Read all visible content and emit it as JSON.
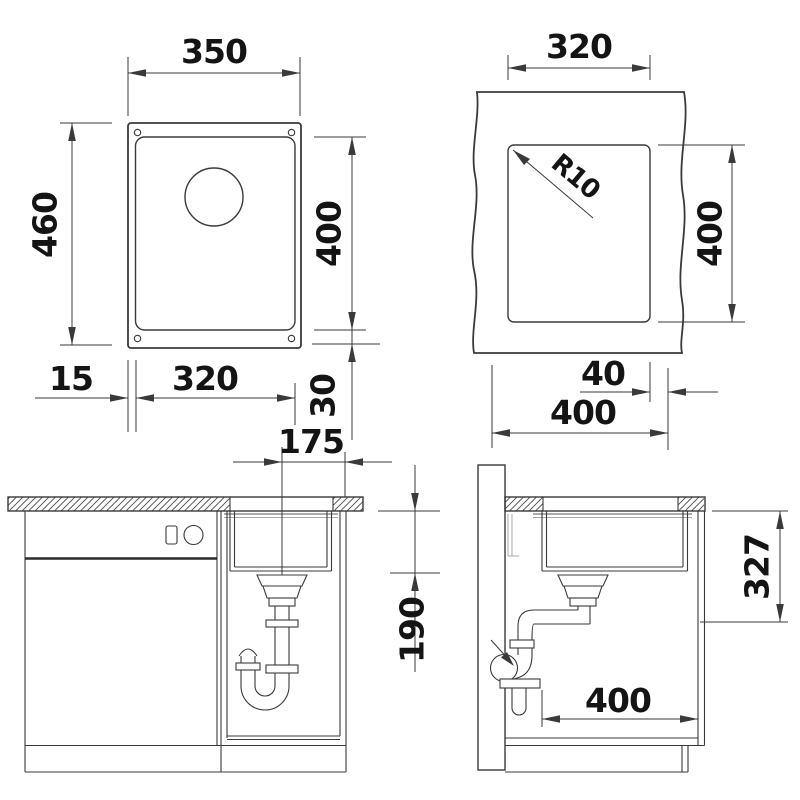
{
  "drawing": {
    "line_color": "#3a3a3a",
    "text_color": "#141414",
    "views": {
      "top_view": {
        "name": "Sink top view",
        "dim_overall_width": "350",
        "dim_overall_depth": "460",
        "dim_bowl_depth": "400",
        "dim_bowl_width": "320",
        "dim_side_offset": "15",
        "dim_bottom_offset": "30"
      },
      "cutout_view": {
        "name": "Worktop cutout view",
        "dim_cutout_width": "320",
        "dim_cutout_depth": "400",
        "corner_radius": "R10",
        "dim_edge_distance": "40",
        "dim_cabinet_width": "400"
      },
      "front_view": {
        "name": "Installation front view",
        "dim_drain_offset": "175",
        "dim_clearance_depth": "190"
      },
      "side_view": {
        "name": "Installation side view",
        "dim_install_depth": "327",
        "dim_cabinet_depth": "400"
      }
    }
  }
}
